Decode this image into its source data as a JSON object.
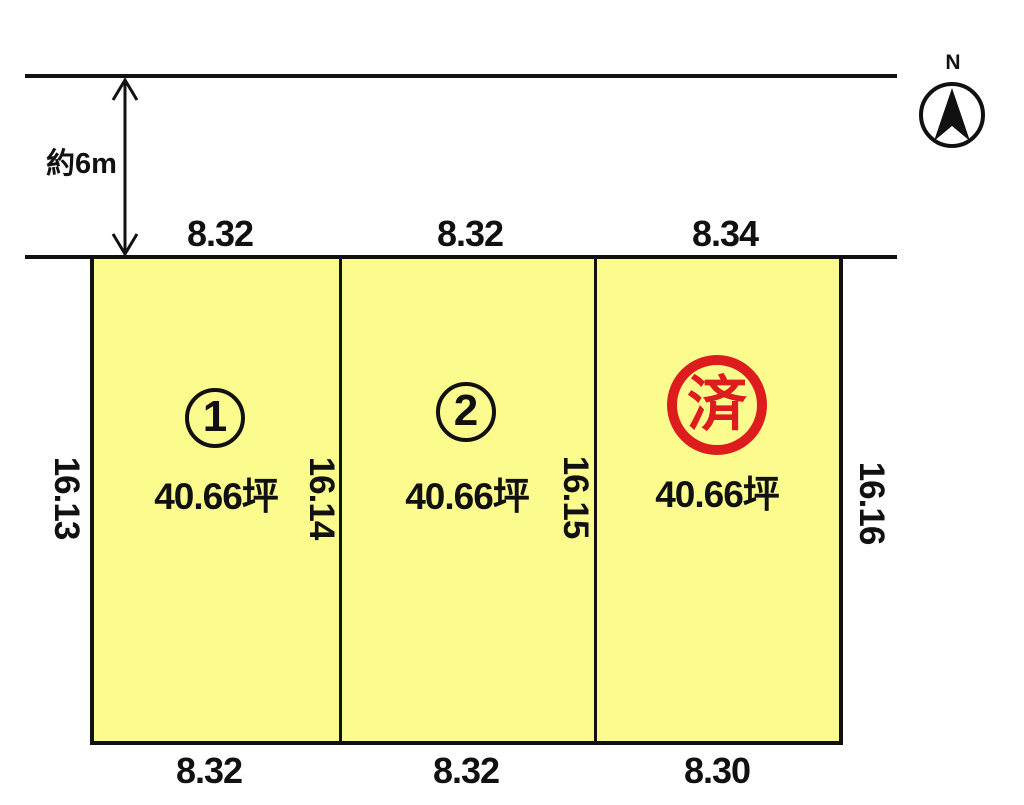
{
  "diagram": {
    "road": {
      "width_label": "約6m"
    },
    "compass": {
      "label": "N"
    },
    "left_boundary_dim": "16.13",
    "plots": [
      {
        "number": "1",
        "area": "40.66坪",
        "top_dim": "8.32",
        "bottom_dim": "8.32",
        "right_dim": "16.14",
        "status": "available"
      },
      {
        "number": "2",
        "area": "40.66坪",
        "top_dim": "8.32",
        "bottom_dim": "8.32",
        "right_dim": "16.15",
        "status": "available"
      },
      {
        "number": "",
        "sold_label": "済",
        "area": "40.66坪",
        "top_dim": "8.34",
        "bottom_dim": "8.30",
        "right_dim": "16.16",
        "status": "sold"
      }
    ],
    "colors": {
      "plot_fill": "#FCFC8E",
      "line": "#111111",
      "sold_red": "#DD1D1D"
    }
  }
}
